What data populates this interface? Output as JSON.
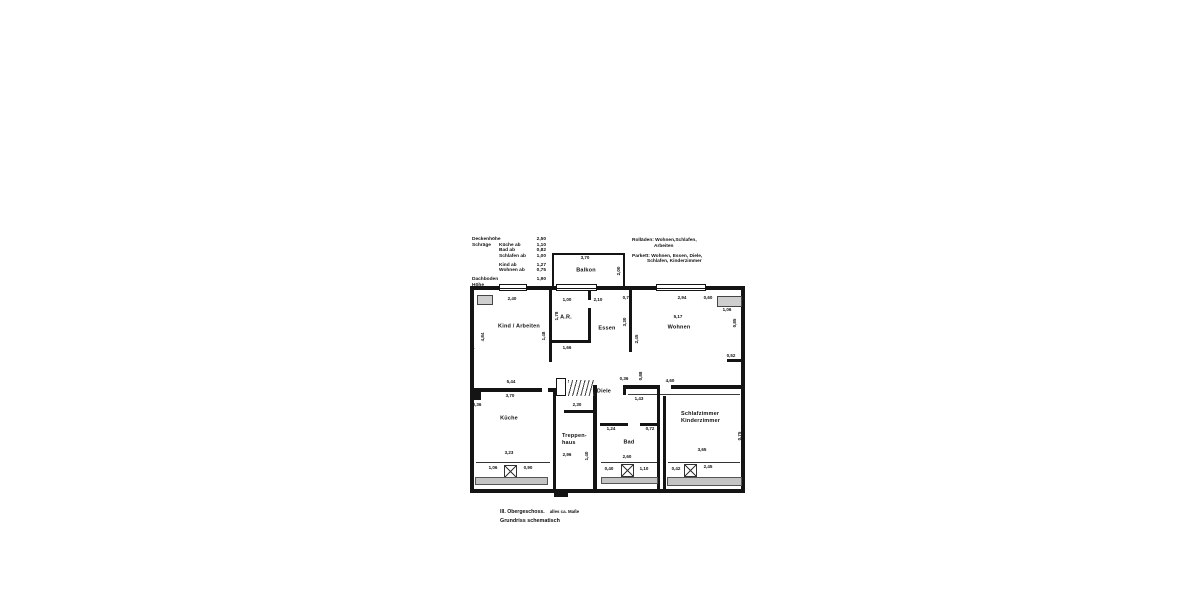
{
  "plan": {
    "notes_left": {
      "rows": [
        {
          "c1": "Deckenhöhe",
          "c2": "",
          "c3": "2,50"
        },
        {
          "c1": "Schräge",
          "c2": "Küche   ab",
          "c3": "1,10"
        },
        {
          "c1": "",
          "c2": "Bad     ab",
          "c3": "0,82"
        },
        {
          "c1": "",
          "c2": "Schlafen ab",
          "c3": "1,00"
        },
        {
          "c1": "",
          "c2": "Kind    ab",
          "c3": "1,27"
        },
        {
          "c1": "",
          "c2": "Wohnen ab",
          "c3": "0,75"
        },
        {
          "c1": "Dachboden Höhe",
          "c2": "",
          "c3": "1,90"
        }
      ]
    },
    "notes_right": {
      "line1": "Rolläden: Wohnen,Schlafen,",
      "line2": "Arbeiten",
      "line3": "Parkett: Wohnen, Essen, Diele,",
      "line4": "Schlafen, Kinderzimmer"
    },
    "rooms": {
      "balkon": "Balkon",
      "kind": "Kind / Arbeiten",
      "ar": "A.R.",
      "essen": "Essen",
      "wohnen": "Wohnen",
      "kueche": "Küche",
      "treppenhaus_1": "Treppen-",
      "treppenhaus_2": "haus",
      "diele": "Diele",
      "bad": "Bad",
      "schlaf_1": "Schlafzimmer",
      "schlaf_2": "Kinderzimmer"
    },
    "dims": [
      {
        "v": "3,70"
      },
      {
        "v": "2,00"
      },
      {
        "v": "2,40"
      },
      {
        "v": "1,00"
      },
      {
        "v": "2,10"
      },
      {
        "v": "0,76"
      },
      {
        "v": "2,94"
      },
      {
        "v": "0,60"
      },
      {
        "v": "1,06"
      },
      {
        "v": "5,17"
      },
      {
        "v": "1,78"
      },
      {
        "v": "1,48"
      },
      {
        "v": "4,84"
      },
      {
        "v": "3,50"
      },
      {
        "v": "1,66"
      },
      {
        "v": "3,30"
      },
      {
        "v": "2,45"
      },
      {
        "v": "0,85"
      },
      {
        "v": "0,52"
      },
      {
        "v": "5,44"
      },
      {
        "v": "3,70"
      },
      {
        "v": "0,36"
      },
      {
        "v": "2,30"
      },
      {
        "v": "2,96"
      },
      {
        "v": "1,40"
      },
      {
        "v": "1,06"
      },
      {
        "v": "0,90"
      },
      {
        "v": "3,23"
      },
      {
        "v": "4,60"
      },
      {
        "v": "1,43"
      },
      {
        "v": "0,88"
      },
      {
        "v": "0,36"
      },
      {
        "v": "1,24"
      },
      {
        "v": "0,72"
      },
      {
        "v": "2,60"
      },
      {
        "v": "0,40"
      },
      {
        "v": "1,10"
      },
      {
        "v": "0,42"
      },
      {
        "v": "2,45"
      },
      {
        "v": "3,65"
      },
      {
        "v": "0,75"
      }
    ],
    "footer": {
      "floor": "III. Obergeschoss.",
      "approx": "alles ca. Maße",
      "subtitle": "Grundriss schematisch"
    },
    "colors": {
      "wall": "#141414",
      "window_band": "#c4c4c4"
    }
  }
}
